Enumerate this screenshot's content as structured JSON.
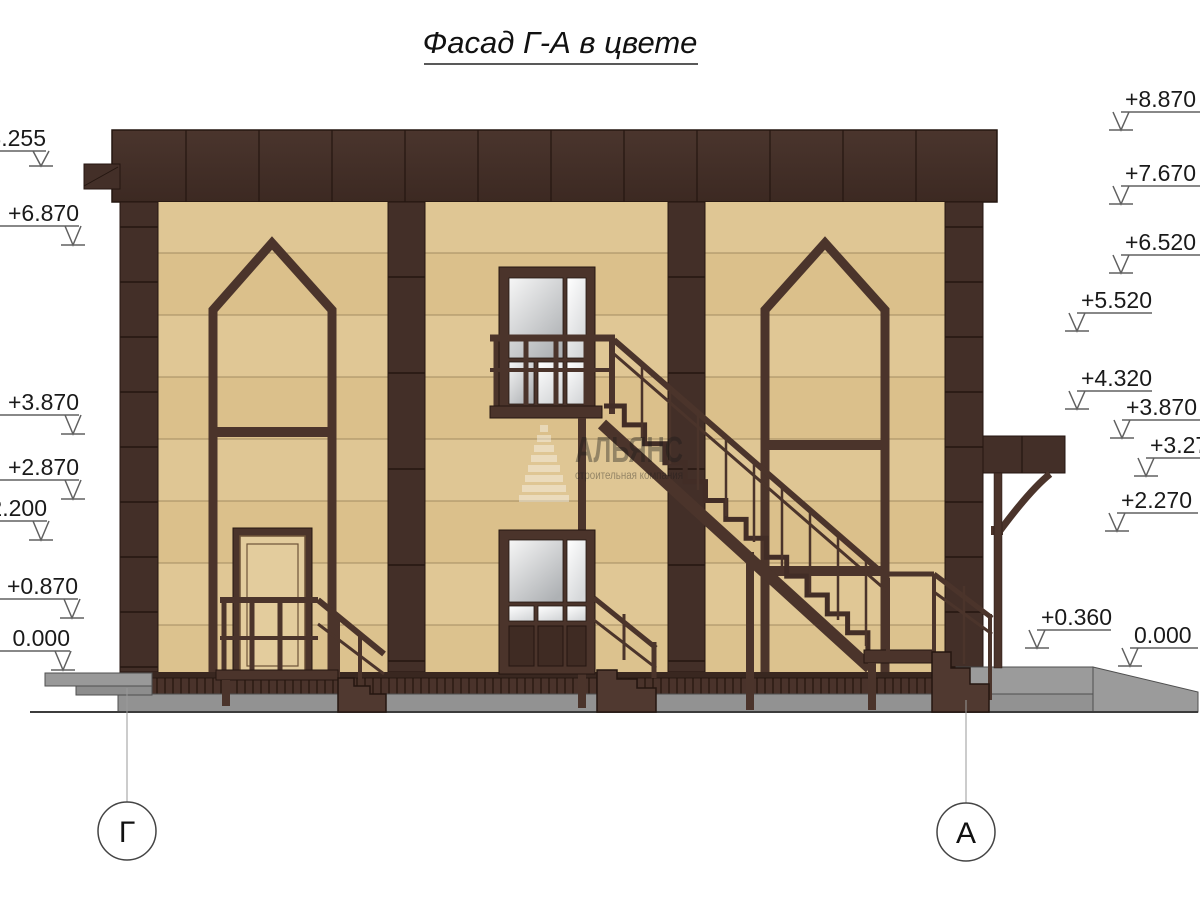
{
  "page": {
    "title": "Фасад Г-А в цвете",
    "background": "#ffffff"
  },
  "axes": {
    "left_label": "Г",
    "right_label": "А"
  },
  "elevation_marks": {
    "left": [
      "+8.255",
      "+6.870",
      "+3.870",
      "+2.870",
      "+2.200",
      "+0.870",
      "0.000"
    ],
    "right": [
      "+8.870",
      "+7.670",
      "+6.520",
      "+5.520",
      "+4.320",
      "+3.870",
      "+3.270",
      "+2.270",
      "+0.360",
      "0.000"
    ]
  },
  "watermark": {
    "brand": "АЛЬЯНС",
    "tagline": "строительная компания"
  },
  "colors": {
    "facade_brown": "#432f28",
    "wall_beige": "#dbc08b",
    "frame_brown": "#4b342b",
    "ground_gray": "#929292",
    "glass_gray": "#b4b6b9"
  }
}
